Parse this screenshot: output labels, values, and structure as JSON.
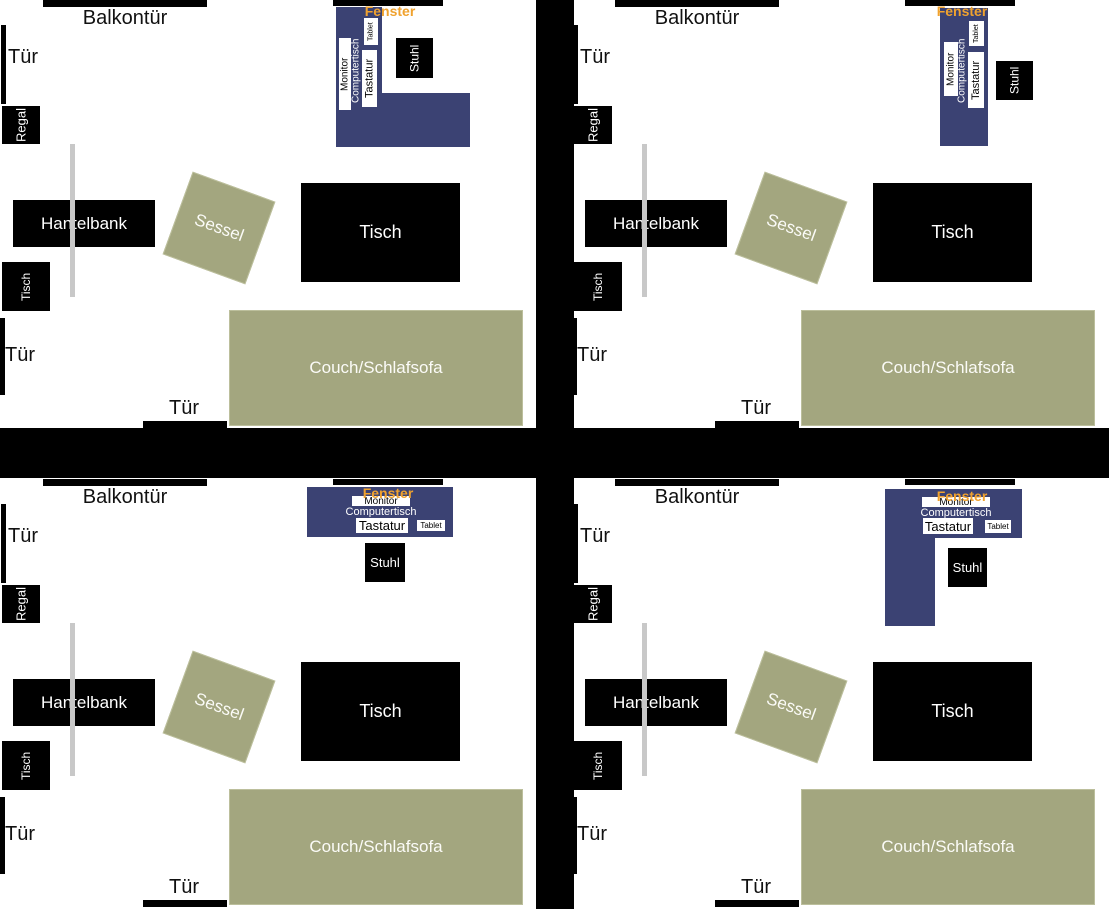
{
  "colors": {
    "wall": "#000000",
    "desk": "#3b4273",
    "upholstery": "#a3a67f",
    "connector_line": "#c8c8c8",
    "window_text": "#f0a22e",
    "background": "#ffffff"
  },
  "labels": {
    "balkontuer": "Balkontür",
    "tuer": "Tür",
    "fenster": "Fenster",
    "regal": "Regal",
    "hantelbank": "Hantelbank",
    "sessel": "Sessel",
    "tisch": "Tisch",
    "tisch_klein": "Tisch",
    "couch": "Couch/Schlafsofa",
    "stuhl": "Stuhl",
    "monitor": "Monitor",
    "computertisch": "Computertisch",
    "tastatur": "Tastatur",
    "tablet": "Tablet"
  },
  "quadrants": [
    {
      "id": "top-left",
      "position": "tl",
      "desk_variant": "l-vertical"
    },
    {
      "id": "top-right",
      "position": "tr",
      "desk_variant": "straight-vertical"
    },
    {
      "id": "bottom-left",
      "position": "bl",
      "desk_variant": "straight-horizontal"
    },
    {
      "id": "bottom-right",
      "position": "br",
      "desk_variant": "l-horizontal"
    }
  ]
}
